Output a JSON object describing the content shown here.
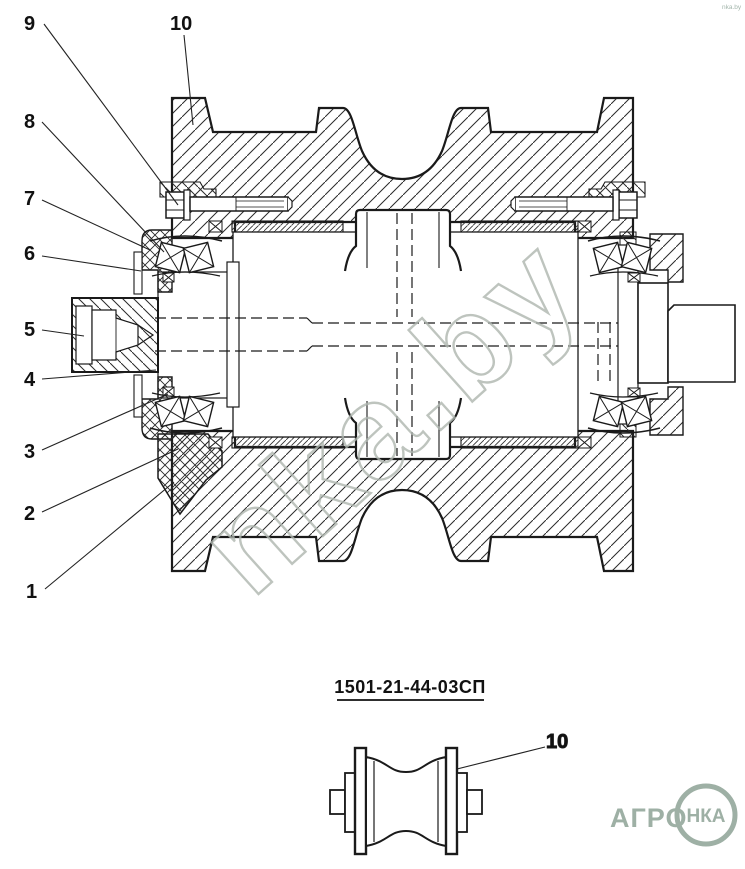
{
  "main_view": {
    "callouts": {
      "n1": "1",
      "n2": "2",
      "n3": "3",
      "n4": "4",
      "n5": "5",
      "n6": "6",
      "n7": "7",
      "n8": "8",
      "n9": "9",
      "n10": "10"
    }
  },
  "caption": {
    "part_number": "1501-21-44-03СП"
  },
  "detail_view": {
    "callout": "10"
  },
  "watermark": {
    "text": "nka.by",
    "color": "#AEB6AF"
  },
  "corner_mark": {
    "text": "nka.by",
    "color": "#93A99D"
  },
  "logo": {
    "brand": "АГРО",
    "badge": "НКА",
    "color": "#9EB0A5"
  },
  "colors": {
    "line": "#1a1a1a",
    "background": "#ffffff"
  }
}
